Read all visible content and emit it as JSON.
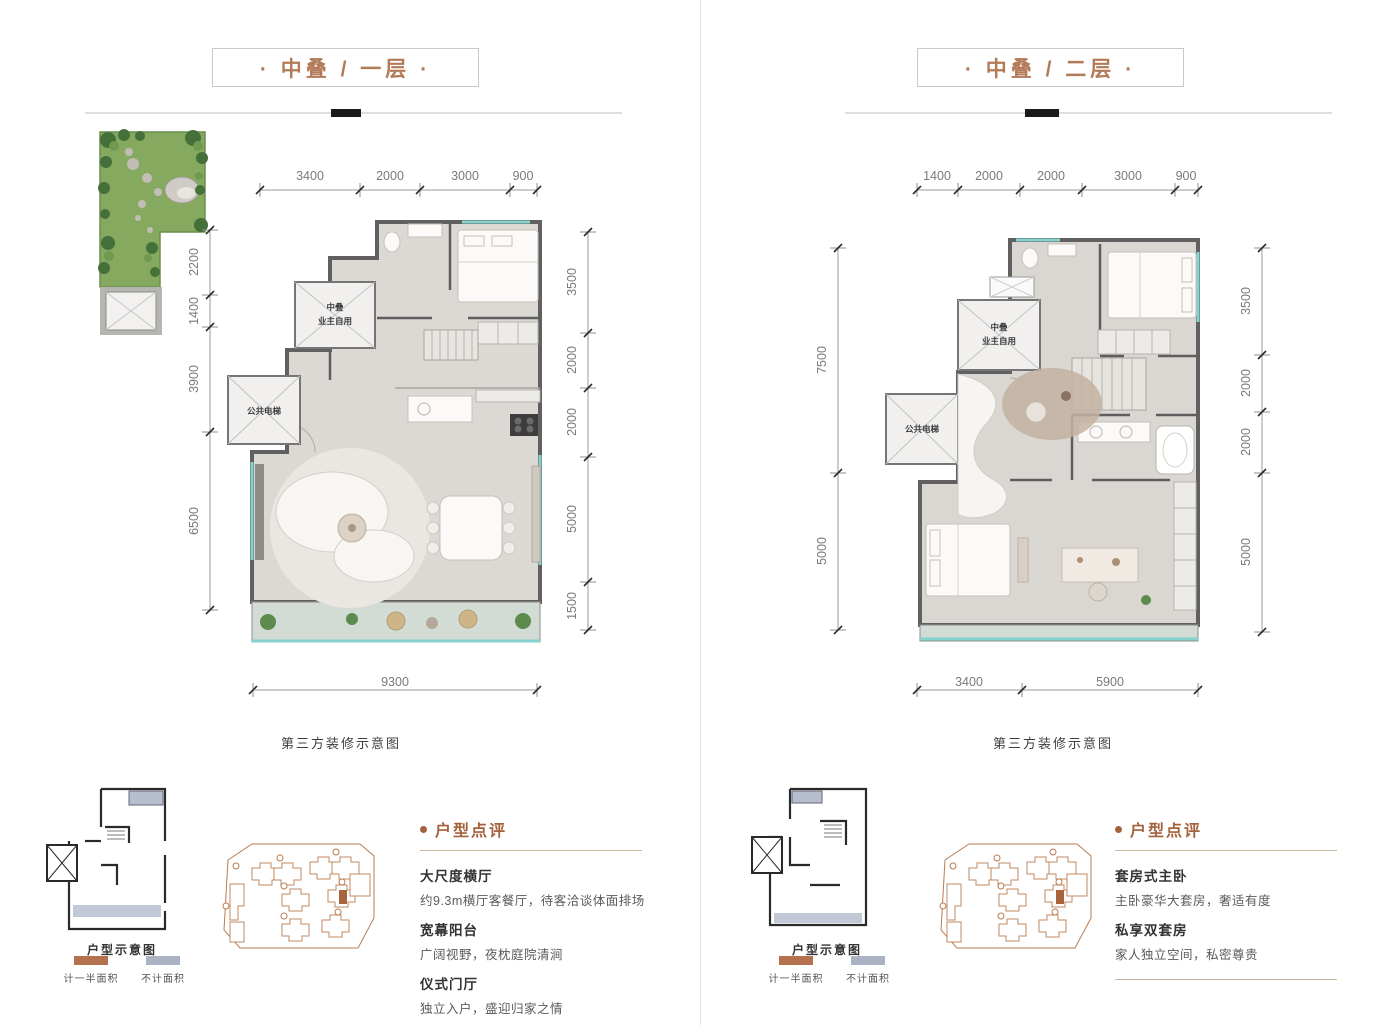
{
  "colors": {
    "accent_brown": "#b37a58",
    "review_heading_brown": "#a4613b",
    "legend_half_area": "#b4714e",
    "legend_no_area": "#a9b3c4",
    "balcony_glass_teal": "#85d2ce",
    "garden_green": "#85a95f",
    "site_plan_orange": "#b97c52"
  },
  "panels": [
    {
      "title": "· 中叠 / 一层 ·",
      "caption": "第三方装修示意图",
      "thumb_label": "户型示意图",
      "legend": [
        {
          "label": "计一半面积"
        },
        {
          "label": "不计面积"
        }
      ],
      "elevator": {
        "private_line1": "中叠",
        "private_line2": "业主自用",
        "public": "公共电梯"
      },
      "dims": {
        "top": [
          "3400",
          "2000",
          "3000",
          "900"
        ],
        "left": [
          "2200",
          "1400",
          "3900",
          "6500"
        ],
        "right": [
          "3500",
          "2000",
          "2000",
          "5000",
          "1500"
        ],
        "bottom": [
          "9300"
        ]
      },
      "review": {
        "heading": "户型点评",
        "items": [
          {
            "title": "大尺度横厅",
            "desc": "约9.3m横厅客餐厅，待客洽谈体面排场"
          },
          {
            "title": "宽幕阳台",
            "desc": "广阔视野，夜枕庭院清涧"
          },
          {
            "title": "仪式门厅",
            "desc": "独立入户，盛迎归家之情"
          }
        ]
      }
    },
    {
      "title": "· 中叠 / 二层 ·",
      "caption": "第三方装修示意图",
      "thumb_label": "户型示意图",
      "legend": [
        {
          "label": "计一半面积"
        },
        {
          "label": "不计面积"
        }
      ],
      "elevator": {
        "private_line1": "中叠",
        "private_line2": "业主自用",
        "public": "公共电梯"
      },
      "dims": {
        "top": [
          "1400",
          "2000",
          "2000",
          "3000",
          "900"
        ],
        "left": [
          "7500",
          "5000"
        ],
        "right": [
          "3500",
          "2000",
          "2000",
          "5000"
        ],
        "bottom": [
          "3400",
          "5900"
        ]
      },
      "review": {
        "heading": "户型点评",
        "items": [
          {
            "title": "套房式主卧",
            "desc": "主卧豪华大套房，奢适有度"
          },
          {
            "title": "私享双套房",
            "desc": "家人独立空间，私密尊贵"
          }
        ]
      }
    }
  ]
}
